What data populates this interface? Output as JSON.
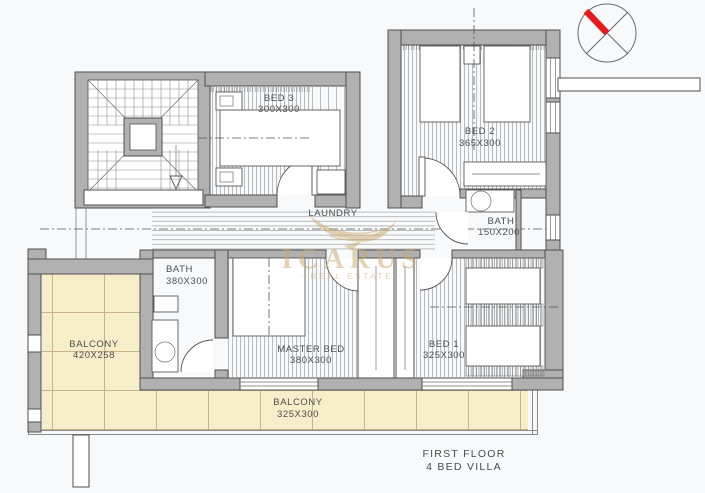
{
  "title": {
    "line1": "FIRST FLOOR",
    "line2": "4 BED VILLA"
  },
  "watermark": {
    "brand": "ICARUS",
    "tagline": "- REAL ESTATE -",
    "logo": "wings-icon"
  },
  "compass": {
    "icon": "compass-north-icon"
  },
  "rooms": {
    "bed3": {
      "name": "BED 3",
      "size": "300X300"
    },
    "bed2": {
      "name": "BED 2",
      "size": "365X300"
    },
    "laundry": {
      "name": "LAUNDRY"
    },
    "bath_small": {
      "name": "BATH",
      "size": "150X200"
    },
    "bath_master": {
      "name": "BATH",
      "size": "380X300"
    },
    "balcony_left": {
      "name": "BALCONY",
      "size": "420X258"
    },
    "master": {
      "name": "MASTER BED",
      "size": "380X300"
    },
    "bed1": {
      "name": "BED 1",
      "size": "325X300"
    },
    "balcony_bottom": {
      "name": "BALCONY",
      "size": "325X300"
    }
  },
  "colors": {
    "bg": "#f7f9fa",
    "wall": "#b1b1b1",
    "wall_stroke": "#4f4f4f",
    "balcony_fill": "#f6edc9",
    "tile_line": "#c6b488",
    "compass_needle": "#e8191c",
    "watermark": "#c9a96a"
  }
}
